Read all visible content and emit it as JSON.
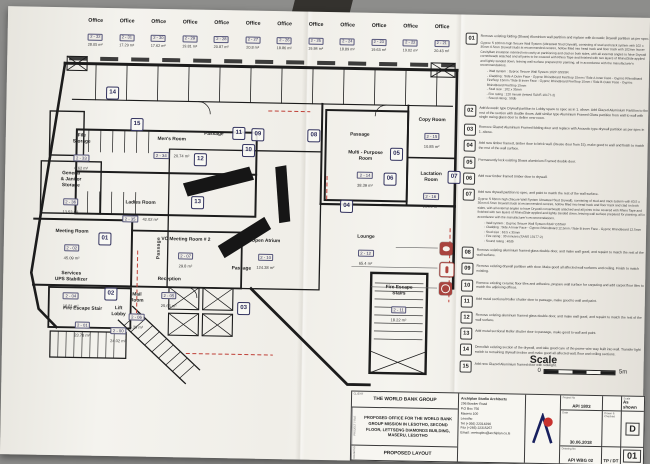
{
  "colors": {
    "photo_bg": "#8d8d8b",
    "paper": "#f3f2ec",
    "ink": "#1c1c1c",
    "marker_blue": "#33335f",
    "accent_red": "#bf4038"
  },
  "offices": [
    {
      "label": "Office",
      "number": "2 - 32",
      "area": "28.05 m²"
    },
    {
      "label": "Office",
      "number": "2 - 31",
      "area": "17.29 m²"
    },
    {
      "label": "Office",
      "number": "2 - 30",
      "area": "17.62 m²"
    },
    {
      "label": "Office",
      "number": "2 - 29",
      "area": "19.81 m²"
    },
    {
      "label": "Office",
      "number": "2 - 28",
      "area": "20.87 m²"
    },
    {
      "label": "Office",
      "number": "2 - 27",
      "area": "20.8 m²"
    },
    {
      "label": "Office",
      "number": "2 - 26",
      "area": "18.86 m²"
    },
    {
      "label": "Office",
      "number": "2 - 25",
      "area": "19.84 m²"
    },
    {
      "label": "Office",
      "number": "2 - 24",
      "area": "18.89 m²"
    },
    {
      "label": "Office",
      "number": "2 - 23",
      "area": "19.63 m²"
    },
    {
      "label": "Office",
      "number": "2 - 22",
      "area": "19.02 m²"
    },
    {
      "label": "Office",
      "number": "2 - 21",
      "area": "20.43 m²"
    }
  ],
  "plan": {
    "passages": [
      "Passage",
      "Passage",
      "Passage",
      "Passage"
    ],
    "rooms": [
      {
        "name": "File\nStorage",
        "number": "2 - 33",
        "area": "6.62 m²"
      },
      {
        "name": "Men's Room",
        "number": "2 - 34",
        "area": "20.74 m²"
      },
      {
        "name": "General\n& Janitor\nStorage",
        "number": "2 - 36",
        "area": "13.53 m²"
      },
      {
        "name": "Ladies Room",
        "number": "2 - 35",
        "area": "42.02 m²"
      },
      {
        "name": "Meeting Room",
        "number": "2 - 02",
        "area": "45.09 m²"
      },
      {
        "name": "VC Meeting Room # 2",
        "number": "2 - 07",
        "area": "29.8 m²"
      },
      {
        "name": "Reception",
        "number": "2 - 05",
        "area": "25.66 m²"
      },
      {
        "name": "Mail\nRoom",
        "number": "2 - 06",
        "area": "6.39 m²"
      },
      {
        "name": "Lift\nLobby",
        "number": "2 - 00",
        "area": "24.02 m²"
      },
      {
        "name": "Fire Escape Stair",
        "number": "2 - 01",
        "area": "23.78 m²"
      },
      {
        "name": "Services\nUPS Stabilizer",
        "number": "2 - 04",
        "area": "16.81 m²"
      },
      {
        "name": "Open Atrium",
        "number": "2 - 10",
        "area": "124.38 m²"
      },
      {
        "name": "Lounge",
        "number": "2 - 12",
        "area": "65.4 m²"
      },
      {
        "name": "Multi - Purpose\nRoom",
        "number": "2 - 14",
        "area": "38.39 m²"
      },
      {
        "name": "Copy Room",
        "number": "2 - 15",
        "area": "10.85 m²"
      },
      {
        "name": "Lactation\nRoom",
        "number": "2 - 16",
        "area": "10.24 m²"
      },
      {
        "name": "Fire Escape\nStairs",
        "number": "2 - 11",
        "area": "18.22 m²"
      }
    ],
    "markers": [
      "01",
      "02",
      "03",
      "04",
      "05",
      "06",
      "07",
      "08",
      "09",
      "10",
      "11",
      "12",
      "13",
      "14",
      "15"
    ],
    "safety_icons": [
      "fire-alarm",
      "fire-extinguisher",
      "hose-reel"
    ]
  },
  "notes": [
    {
      "num": "01",
      "text": "Remove existing folding (Stowa) Aluminium wall partition and replace with Acoustic Drywall partition as per spec.",
      "spec": "Gyproc S 100mm high Secure Wall System (Ultrasteel Stud Drywall), consisting of stud and track system with 102 x 35mm 0.5mm Drywall studs at recommended centres, hollow filled into head track and floor track with 102mm Isover CavityBatt insulation inserted into cavity at partitioning and clad on both sides, with all external angles to have Drywall cornerbeads attached and all joints to be covered with Rhino Tape and finished with two layers of RhinoGlide applied and lightly sanded down, leaving wall surface prepared for painting, all in accordance with the manufacturer's recommendations.",
      "bullets": "- Wall system : Gyproc Secure Wall System 102P GSSSR\n- Cladding : Side A Outer Face - Gyproc RhinoBoard FireStop 15mm / Side A Inner Face - Gyproc RhinoBoard FireStop 15mm / Side B Inner Face - Gyproc RhinoBoard FireStop 15mm / Side B Outer Face - Gyproc RhinoBoard FireStop 15mm\n- Stud size : 102 x 35mm\n- Fire rating : 120 minute (tested SANS 10177-2)\n- Sound rating : 50db"
    },
    {
      "num": "02",
      "text": "Add Acoustic type Drywall partition to Lobby space to spec as in 1. above. Add Glazed Aluminium Partition to the rest of the section with double doors. Add similar type Aluminium Framed Glass partition from wall to wall with single swing glass door to define new room."
    },
    {
      "num": "03",
      "text": "Remove Glazed Aluminium Framed folding door and replace with Acoustic type drywall partition as per spec in 1. above."
    },
    {
      "num": "04",
      "text": "Add new timber framed, timber door to brick wall. (Reuse door from 15), make good to wall and finish to match the rest of the wall surface."
    },
    {
      "num": "05",
      "text": "Permanently lock existing Stowa aluminium Framed double door."
    },
    {
      "num": "06",
      "text": "Add new timber framed timber door to drywall."
    },
    {
      "num": "07",
      "text": "Add new drywall partition to spec, and paint to match the rest of the wall surface.",
      "spec": "Gyproc S 63mm high (Secure Wall System Ultrasteel Stud Drywall), consisting of stud and track system with 63.5 x 35mm 0.5mm Drywall studs at recommended centres, hollow filled into head track and floor track and clad on both sides, with all external angles to have Drywall cornerbeads attached and all joints to be covered with Rhino Tape and finished with two layers of RhinoGlide applied and lightly sanded down, leaving wall surface prepared for painting, all in accordance with the manufacturer's recommendations.",
      "bullets": "- Wall system : Gyproc Secure Wall System 63AP GSSAV\n- Cladding : Side A Inner Face - Gyproc RhinoBoard 12.5mm / Side B Inner Face - Gyproc RhinoBoard 12.5mm\n- Stud size : 63.5 x 35mm\n- Fire rating : 30 minutes (SANS 10177-2)\n- Sound rating : 40db"
    },
    {
      "num": "08",
      "text": "Remove existing aluminium framed glass double door, and make wall good, and repaint to match the rest of the wall surface."
    },
    {
      "num": "09",
      "text": "Remove existing drywall partition with door. Make good all affected wall surfaces and ceiling. Finish to match existing."
    },
    {
      "num": "10",
      "text": "Remove existing ceramic floor tiles and adhesive, prepare wall surface for carpeting and add carpet floor tiles to match the adjoining offices."
    },
    {
      "num": "11",
      "text": "Add metal sectional Roller shutter door to passage, make good to wall and paint."
    },
    {
      "num": "12",
      "text": "Remove existing aluminum framed glass double door, and make wall good, and repaint to match the rest of the wall surface."
    },
    {
      "num": "13",
      "text": "Add metal sectional Roller shutter door to passage, make good to wall and paint."
    },
    {
      "num": "14",
      "text": "Demolish existing section of the drywall, and take good care of the power wire way built into wall. Transfer light switch to remaining drywall section and make good all affected wall, floor and ceiling sections."
    },
    {
      "num": "15",
      "text": "Add new Glazed Aluminium framed door with sidelight."
    }
  ],
  "scale_block": {
    "label": "Scale",
    "zero": "0",
    "end": "5m"
  },
  "title_block": {
    "client_label": "CLIENT",
    "client": "THE WORLD BANK GROUP",
    "project_label": "PROJECT TITLE",
    "project": "PROPOSED OFFICE FOR THE WORLD BANK GROUP MISSION IN LESOTHO, SECOND FLOOR, LETTSENG DIAMONDS BUILDING, MASERU, LESOTHO",
    "drawing_label": "DRAWING",
    "drawing": "PROPOSED LAYOUT",
    "architect_name": "Archiplan Studio Architects",
    "architect_lines": "296 Bowker Road\nP.O Box 756\nMaseru 100\nLesotho\nTel (+266) 22314296\nFax (+266) 22315257\nEmail : metroplex@archiplan.co.ls",
    "fields": {
      "project_no_label": "Project No",
      "project_no": "API 1803",
      "scale_label": "Scale",
      "scale": "As shown",
      "date_label": "Date",
      "date": "30.06.2018",
      "drawn_label": "Drawn & Checked",
      "drawn": "TP / DT",
      "drawing_no_label": "Drawing No",
      "drawing_no": "API WBG 02",
      "revision": "D",
      "sheet": "01"
    }
  }
}
